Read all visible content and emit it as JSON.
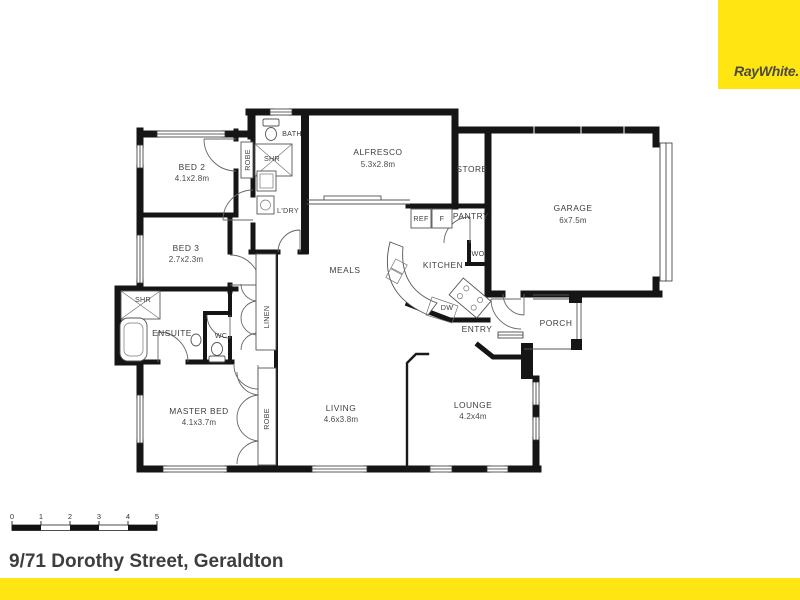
{
  "brand": {
    "logo_text": "RayWhite.",
    "yellow": "#FFE512",
    "logo_text_color": "#4c4a40"
  },
  "floor_plan": {
    "rooms": {
      "bed2": {
        "label": "BED 2",
        "dims": "4.1x2.8m"
      },
      "bed3": {
        "label": "BED 3",
        "dims": "2.7x2.3m"
      },
      "robe_top": {
        "label": "ROBE"
      },
      "bath": {
        "label": "BATH"
      },
      "shr_top": {
        "label": "SHR"
      },
      "ldry": {
        "label": "L'DRY"
      },
      "alfresco": {
        "label": "ALFRESCO",
        "dims": "5.3x2.8m"
      },
      "store": {
        "label": "STORE"
      },
      "garage": {
        "label": "GARAGE",
        "dims": "6x7.5m"
      },
      "ref": {
        "label": "REF"
      },
      "freezer": {
        "label": "F"
      },
      "pantry": {
        "label": "PANTRY"
      },
      "wo": {
        "label": "WO"
      },
      "kitchen": {
        "label": "KITCHEN"
      },
      "meals": {
        "label": "MEALS"
      },
      "dw": {
        "label": "DW"
      },
      "entry": {
        "label": "ENTRY"
      },
      "porch": {
        "label": "PORCH"
      },
      "shr_ensuite": {
        "label": "SHR"
      },
      "ensuite": {
        "label": "ENSUITE"
      },
      "wc": {
        "label": "WC"
      },
      "linen": {
        "label": "LINEN"
      },
      "master": {
        "label": "MASTER BED",
        "dims": "4.1x3.7m"
      },
      "robe_master": {
        "label": "ROBE"
      },
      "living": {
        "label": "LIVING",
        "dims": "4.6x3.8m"
      },
      "lounge": {
        "label": "LOUNGE",
        "dims": "4.2x4m"
      }
    }
  },
  "scale_bar": {
    "ticks": [
      "0",
      "1",
      "2",
      "3",
      "4",
      "5"
    ]
  },
  "footer": {
    "address": "9/71 Dorothy Street, Geraldton"
  }
}
